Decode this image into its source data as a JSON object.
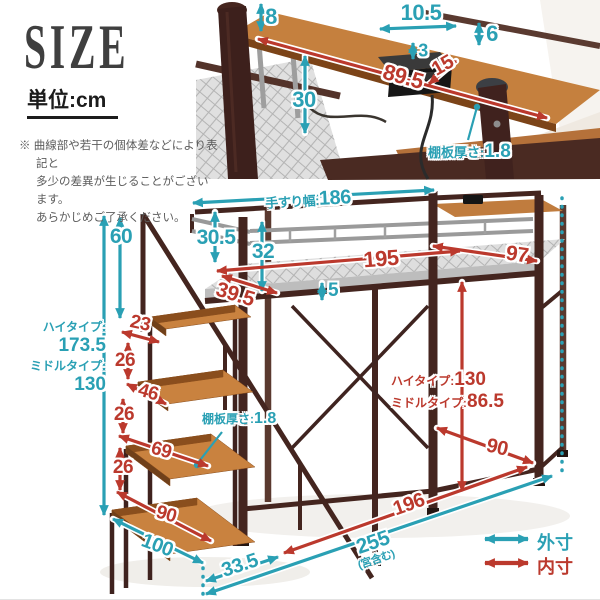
{
  "header": {
    "title": "SIZE",
    "unit": "単位:cm",
    "notes": [
      "※ 曲線部や若干の個体差などにより表記と",
      "多少の差異が生じることがございます。",
      "あらかじめご了承ください。"
    ]
  },
  "c": {
    "d8": "8",
    "d10_5": "10.5",
    "d6": "6",
    "d3": "3",
    "d15": "15",
    "d89_5": "89.5",
    "d30": "30",
    "thick_label": "棚板厚さ:",
    "thick_value": "1.8"
  },
  "b": {
    "rail_label": "手すり幅:",
    "rail_value": "186",
    "d30_5": "30.5",
    "d32": "32",
    "d195": "195",
    "d39_5": "39.5",
    "d5": "5",
    "d97": "97",
    "high_label": "ハイタイプ:",
    "high_value": "130",
    "mid_label": "ミドルタイプ:",
    "mid_value": "86.5",
    "d90": "90",
    "d196": "196",
    "d255": "255",
    "d255_note": "(宮含む)",
    "d33_5": "33.5"
  },
  "s": {
    "d60": "60",
    "high_label": "ハイタイプ:",
    "high_value": "173.5",
    "mid_label": "ミドルタイプ:",
    "mid_value": "130",
    "d23": "23",
    "d26a": "26",
    "d46": "46",
    "d26b": "26",
    "d69": "69",
    "d26c": "26",
    "d90": "90",
    "d100": "100",
    "thick_label": "棚板厚さ:",
    "thick_value": "1.8"
  },
  "legend": {
    "outer": "外寸",
    "inner": "内寸"
  },
  "colors": {
    "outer": "#2aa0b4",
    "inner": "#bb392d",
    "wood": "#c9823f",
    "frame": "#44251f"
  }
}
